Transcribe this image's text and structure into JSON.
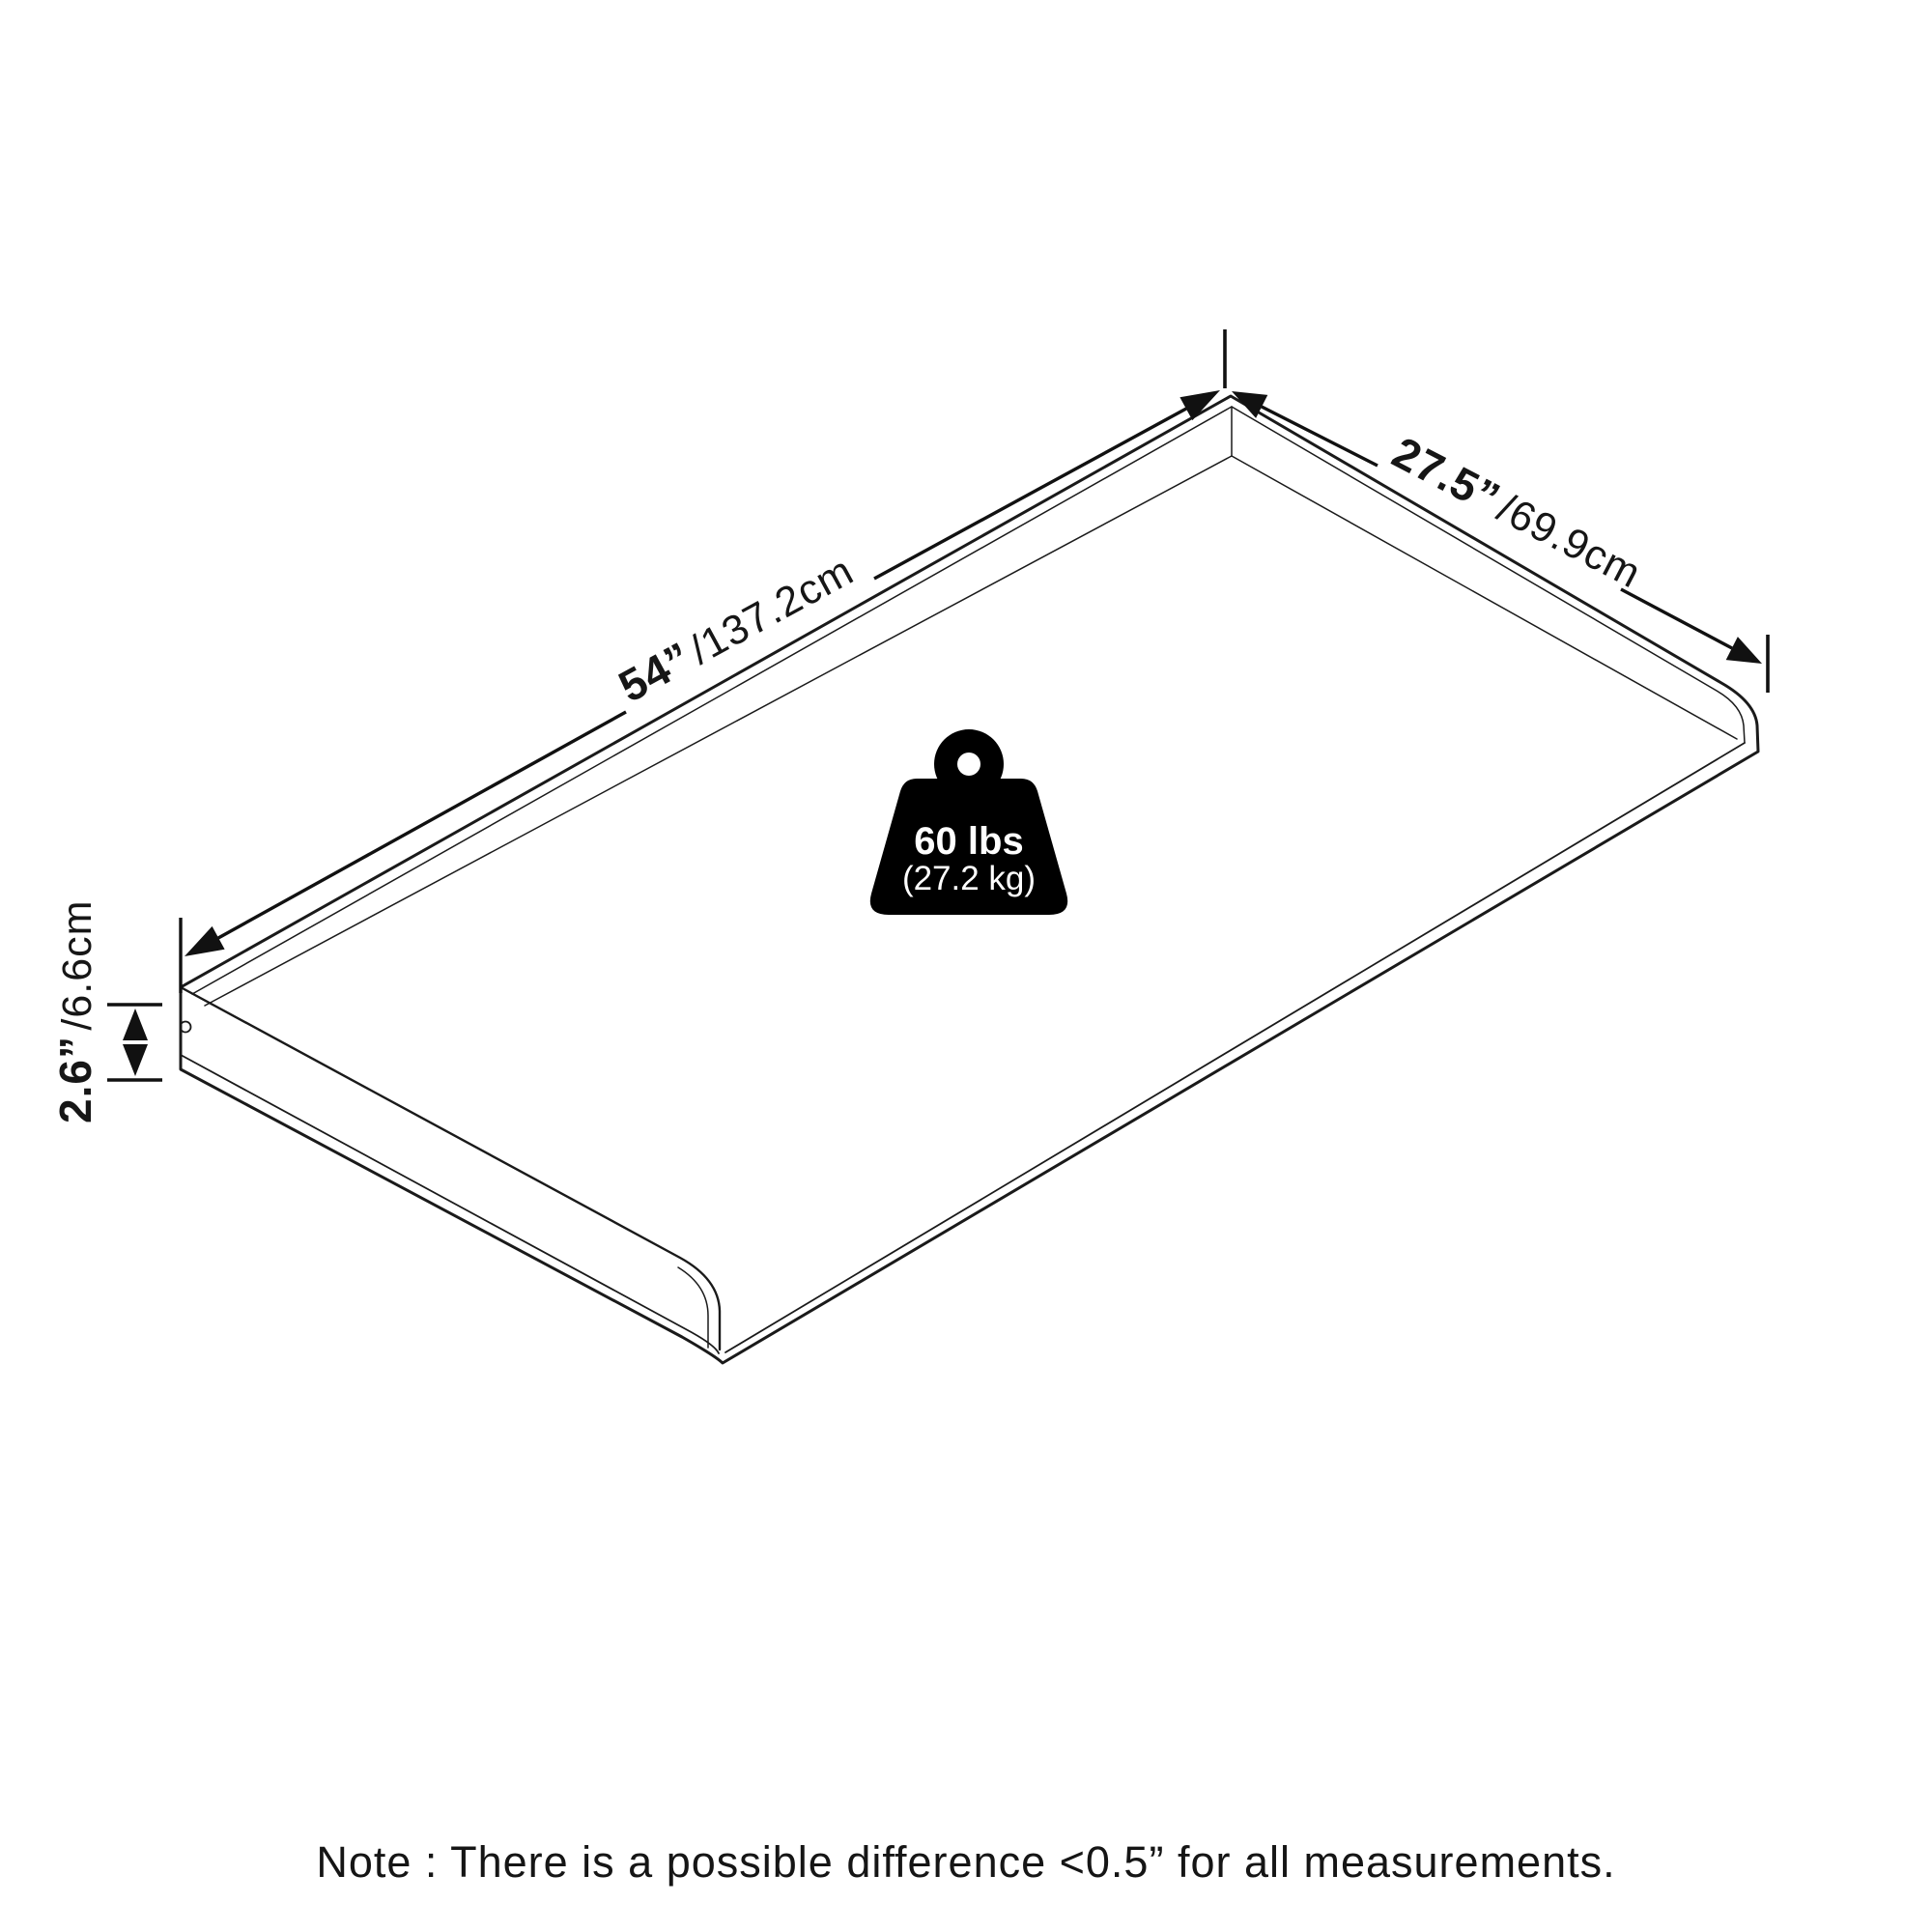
{
  "diagram": {
    "title_hint": "isometric-panel-dimension-diagram",
    "dimensions": {
      "length": {
        "imperial": "54”",
        "metric": "/137.2cm"
      },
      "depth": {
        "imperial": "27.5”",
        "metric": "/69.9cm"
      },
      "height": {
        "imperial": "2.6”",
        "metric": "/6.6cm"
      }
    },
    "weight_capacity": {
      "pounds": "60 lbs",
      "kilograms": "(27.2 kg)"
    }
  },
  "note": {
    "text": "Note : There is a possible difference <0.5” for all measurements."
  },
  "colors": {
    "background": "#ffffff",
    "line": "#1a1a1a",
    "badge_fill": "#000000",
    "badge_text": "#ffffff"
  }
}
